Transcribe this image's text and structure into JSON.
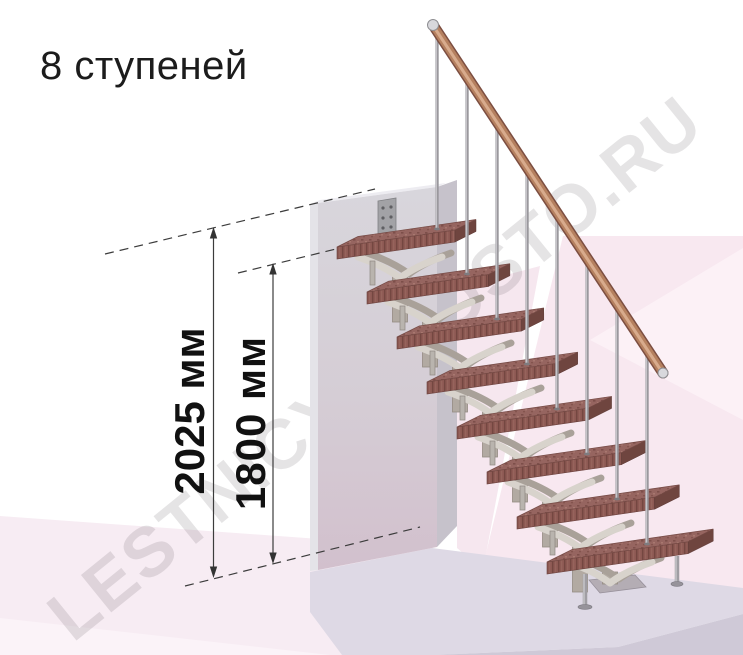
{
  "title": "8 ступеней",
  "watermark_text": "LESTNICY-PROSTO.RU",
  "stairs": {
    "steps_count": 8,
    "steps_label": "8 ступеней"
  },
  "dimensions": {
    "total_height": {
      "label": "2025 мм",
      "value": 2025,
      "unit": "мм"
    },
    "to_top_tread": {
      "label": "1800 мм",
      "value": 1800,
      "unit": "мм"
    }
  },
  "colors": {
    "tread": "#96655f",
    "handrail": "#b5805f",
    "metal_frame": "#b2aaa2",
    "wall": "#d6d4da",
    "floor_pink": "#f7ecf3",
    "platform": "#ded9e5",
    "dimension_text": "#111111",
    "watermark": "#e2e0e1"
  }
}
